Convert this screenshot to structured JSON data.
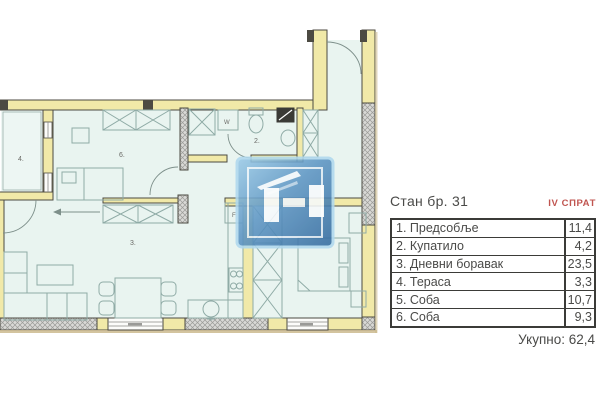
{
  "panel": {
    "title": "Стан бр. 31",
    "floor_label": "IV СПРАТ",
    "rows": [
      {
        "label": "1. Предсобље",
        "area": "11,4"
      },
      {
        "label": "2. Купатило",
        "area": "4,2"
      },
      {
        "label": "3. Дневни боравак",
        "area": "23,5"
      },
      {
        "label": "4. Тераса",
        "area": "3,3"
      },
      {
        "label": "5. Соба",
        "area": "10,7"
      },
      {
        "label": "6. Соба",
        "area": "9,3"
      }
    ],
    "total_label": "Укупно: 62,4"
  },
  "plan": {
    "labels": {
      "room_2": "2.",
      "room_3": "3.",
      "room_4": "4.",
      "room_6": "6.",
      "washing_machine": "W",
      "fridge": "F"
    }
  },
  "colors": {
    "wall_fill": "#F1E9A8",
    "wall_stroke": "#4C4A42",
    "floor": "#E9F4F0",
    "furniture_stroke": "#8FABA6",
    "hatch_fill": "#D9D9D6",
    "accent_red": "#C05550",
    "table_border": "#3B3B38",
    "text": "#4A4A48",
    "logo_blue_light": "#9CCBE8",
    "logo_blue_dark": "#336A9E",
    "shadow_tan": "#CBBA8E"
  }
}
